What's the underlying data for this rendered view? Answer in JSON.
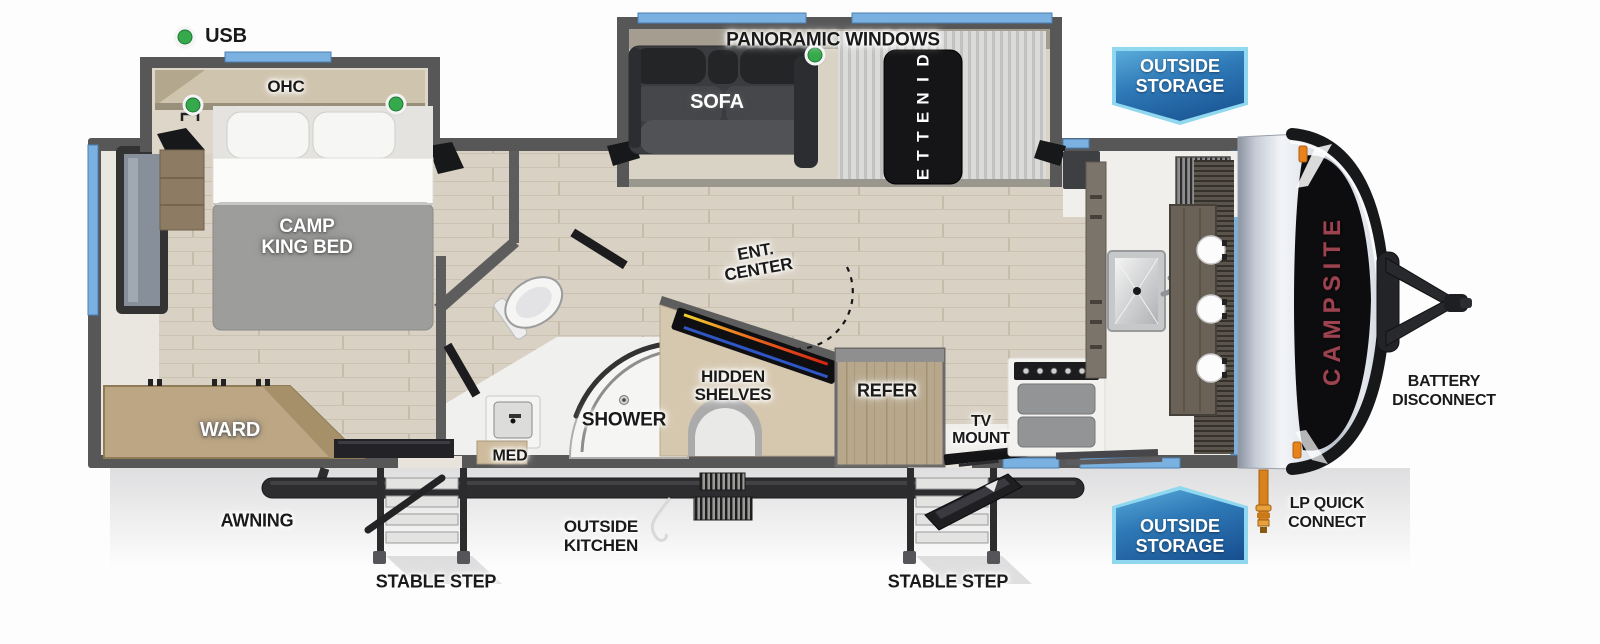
{
  "colors": {
    "badge_border": "#8fd8f0",
    "badge_blue_light": "#4fa0d4",
    "badge_blue_dark": "#174e8e",
    "usb_dot_green": "#35a94b",
    "window_blue": "#7ab1e0",
    "wall_gray": "#575757",
    "brand_red": "#9b434f"
  },
  "exterior": {
    "usb": "USB",
    "panoramic_windows": "PANORAMIC WINDOWS",
    "outside_storage_top": {
      "line1": "OUTSIDE",
      "line2": "STORAGE"
    },
    "outside_storage_bottom": {
      "line1": "OUTSIDE",
      "line2": "STORAGE"
    },
    "awning": "AWNING",
    "outside_kitchen": {
      "line1": "OUTSIDE",
      "line2": "KITCHEN"
    },
    "stable_step_left": "STABLE STEP",
    "stable_step_right": "STABLE STEP",
    "lp_quick_connect": {
      "line1": "LP QUICK",
      "line2": "CONNECT"
    },
    "battery_disconnect": {
      "line1": "BATTERY",
      "line2": "DISCONNECT"
    },
    "brand": "CAMPSITE"
  },
  "interior": {
    "ohc": "OHC",
    "sofa": "SOFA",
    "dinette": "DINETTE",
    "camp_king_bed": {
      "line1": "CAMP",
      "line2": "KING BED"
    },
    "ward": "WARD",
    "shower": "SHOWER",
    "med": "MED",
    "ent_center": {
      "line1": "ENT.",
      "line2": "CENTER"
    },
    "hidden_shelves": {
      "line1": "HIDDEN",
      "line2": "SHELVES"
    },
    "refer": "REFER",
    "tv_mount": {
      "line1": "TV",
      "line2": "MOUNT"
    }
  }
}
